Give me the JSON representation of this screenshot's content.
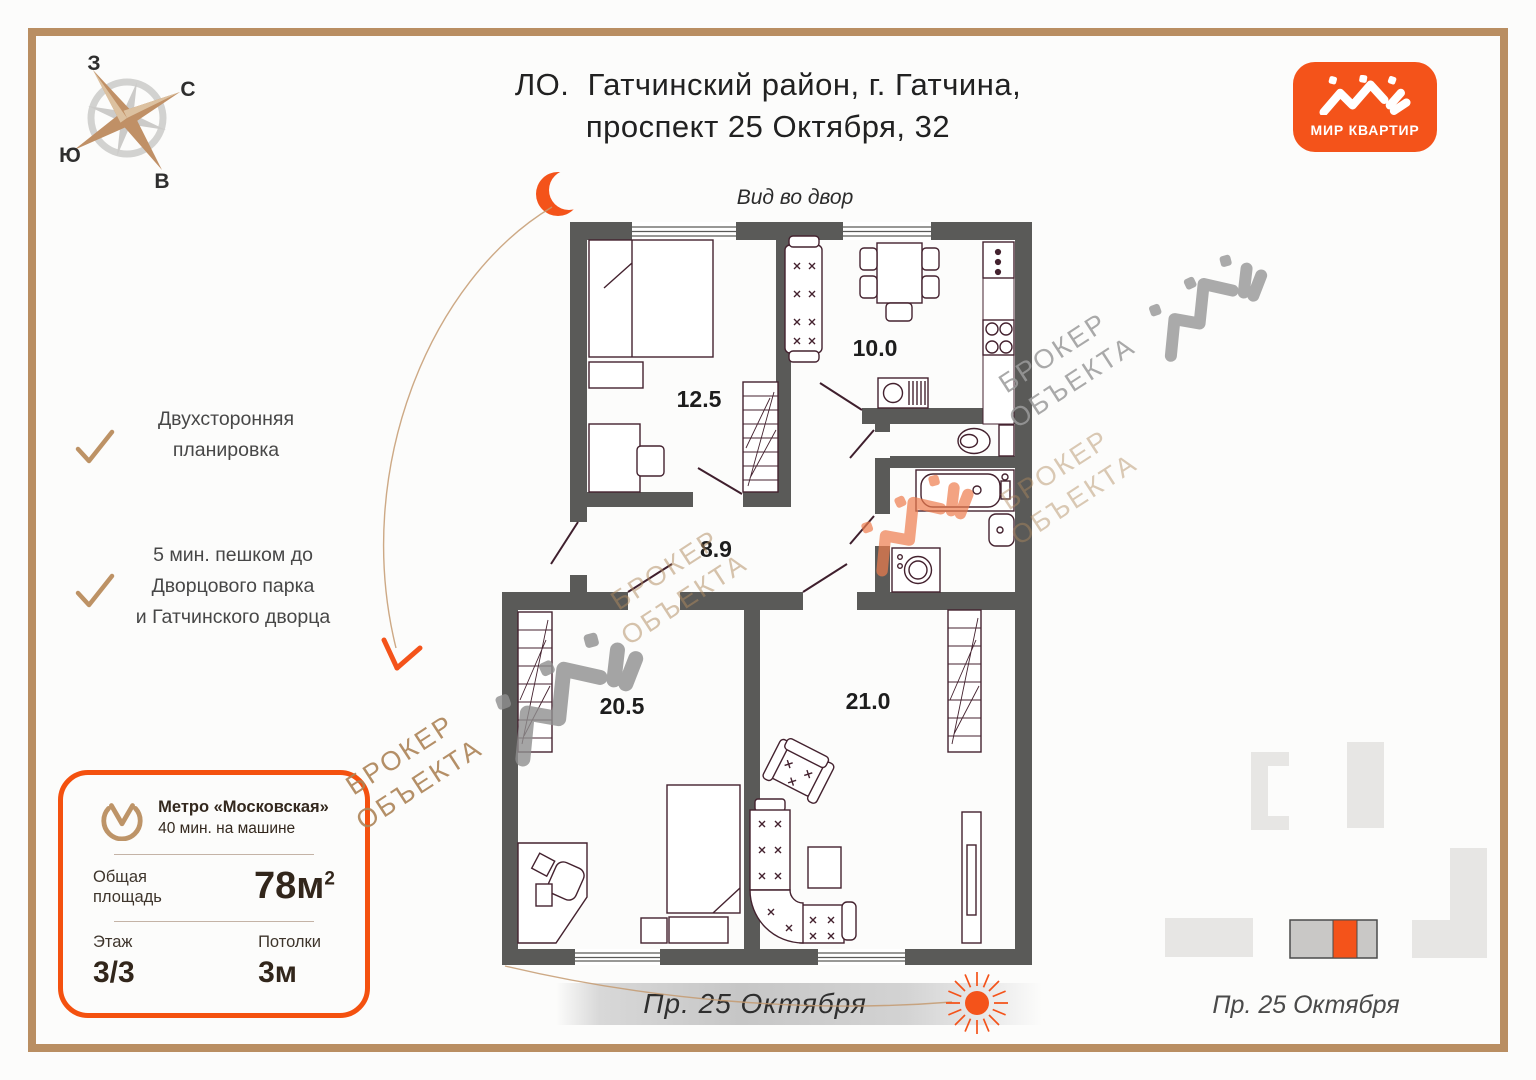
{
  "title": {
    "line1": "ЛО.  Гатчинский район, г. Гатчина,",
    "line2": "проспект 25 Октября, 32"
  },
  "logo": {
    "label": "МИР КВАРТИР",
    "accent_color": "#f4531a"
  },
  "compass": {
    "west": "З",
    "north": "С",
    "south": "Ю",
    "east": "В"
  },
  "plan": {
    "view_label": "Вид во двор",
    "street_label": "Пр. 25 Октября",
    "rooms": [
      {
        "name": "bedroom",
        "area": "12.5"
      },
      {
        "name": "kitchen",
        "area": "10.0"
      },
      {
        "name": "hallway",
        "area": "8.9"
      },
      {
        "name": "room-left",
        "area": "20.5"
      },
      {
        "name": "living-room",
        "area": "21.0"
      }
    ]
  },
  "features": [
    {
      "lines": [
        "Двухсторонняя",
        "планировка"
      ]
    },
    {
      "lines": [
        "5 мин. пешком до",
        "Дворцового парка",
        "и Гатчинского дворца"
      ]
    }
  ],
  "card": {
    "metro_name": "Метро «Московская»",
    "metro_time": "40 мин. на машине",
    "area_label_1": "Общая",
    "area_label_2": "площадь",
    "area_value": "78м",
    "area_sup": "2",
    "floor_label": "Этаж",
    "floor_value": "3/3",
    "ceiling_label": "Потолки",
    "ceiling_value": "3м"
  },
  "minimap": {
    "street_label": "Пр. 25 Октября"
  },
  "watermark": {
    "line1": "БРОКЕР",
    "line2": "ОБЪЕКТА"
  },
  "colors": {
    "accent": "#f4531a",
    "tan": "#c0956b",
    "wall": "#5a5a58"
  }
}
